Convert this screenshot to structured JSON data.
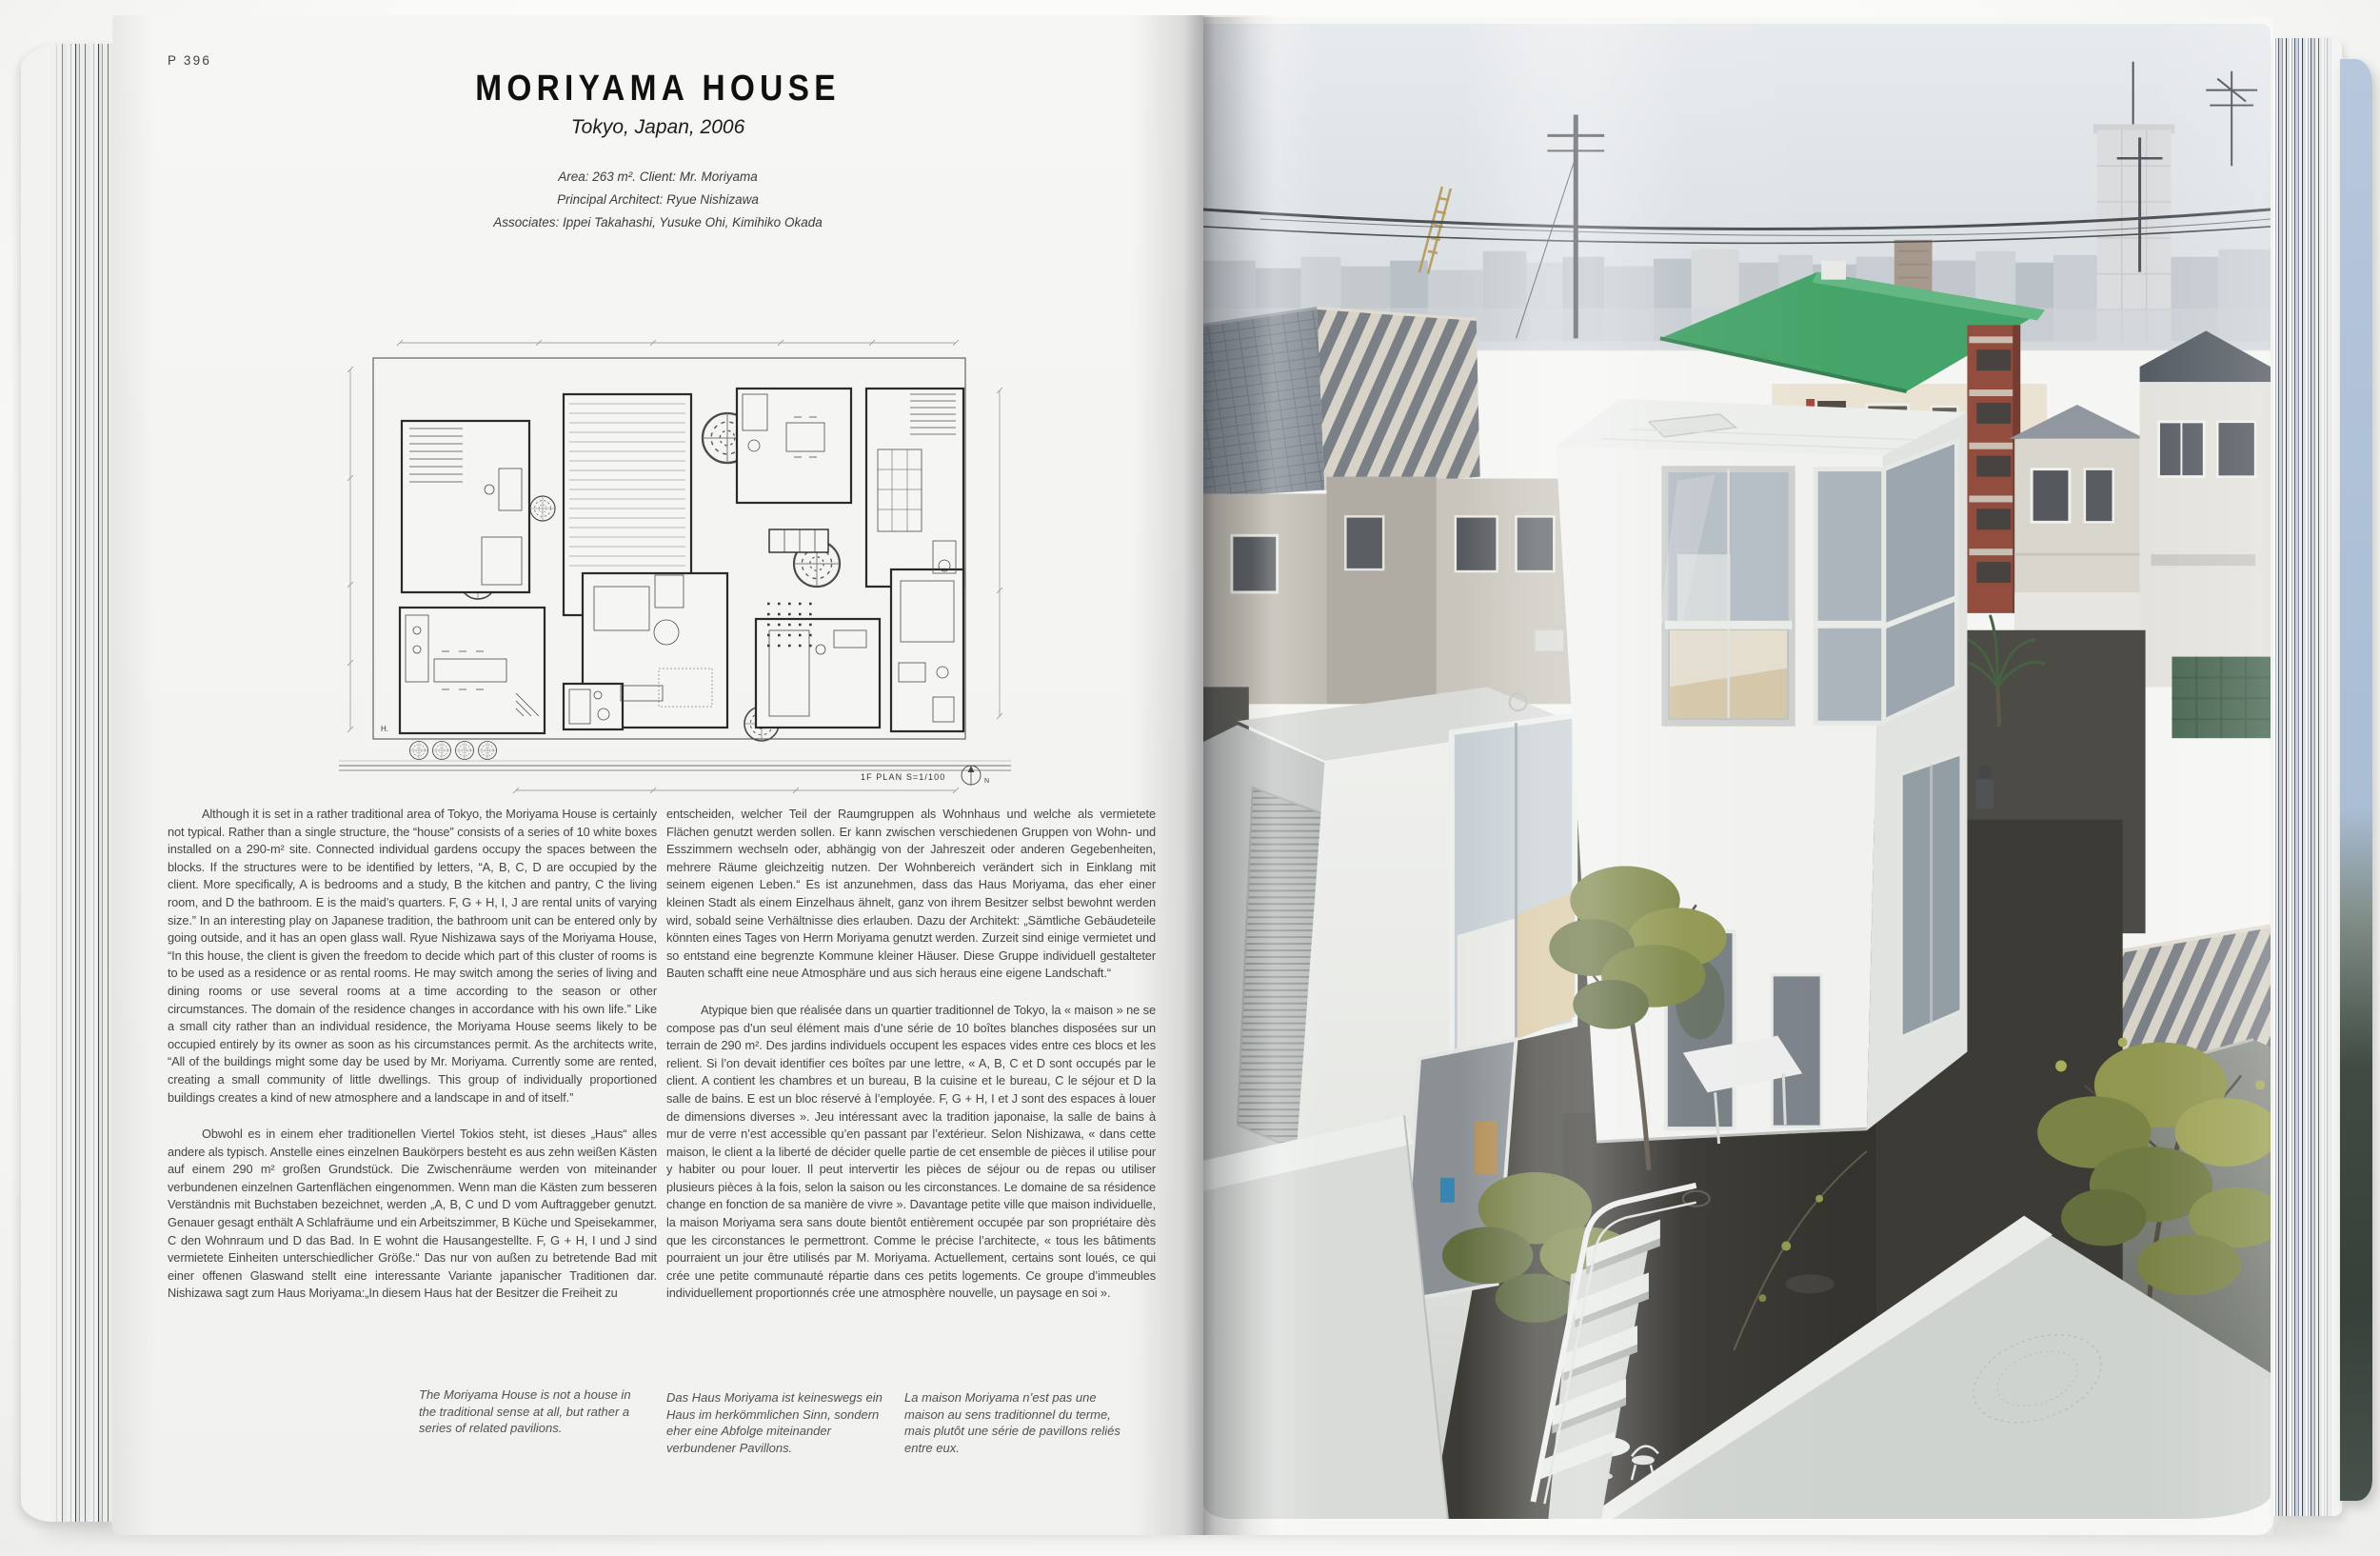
{
  "book": {
    "left_page": {
      "page_number": "P 396",
      "title": "MORIYAMA HOUSE",
      "subtitle": "Tokyo, Japan, 2006",
      "credits": [
        "Area: 263 m². Client: Mr. Moriyama",
        "Principal Architect: Ryue Nishizawa",
        "Associates: Ippei Takahashi, Yusuke Ohi, Kimihiko Okada"
      ],
      "plan_label": "1F PLAN  S=1/100",
      "plan_north": "N",
      "plan_corner_label": "H.",
      "columns": {
        "col1": {
          "en": "Although it is set in a rather traditional area of Tokyo, the Moriyama House is certainly not typical. Rather than a single structure, the “house” consists of a series of 10 white boxes installed on a 290-m² site. Connected individual gardens occupy the spaces between the blocks. If the structures were to be identified by letters, “A, B, C, D are occupied by the client. More specifically, A is bedrooms and a study, B the kitchen and pantry, C the living room, and D the bathroom. E is the maid’s quarters. F, G + H, I, J are rental units of varying size.” In an interesting play on Japanese tradition, the bathroom unit can be entered only by going outside, and it has an open glass wall. Ryue Nishizawa says of the Moriyama House, “In this house, the client is given the freedom to decide which part of this cluster of rooms is to be used as a residence or as rental rooms. He may switch among the series of living and dining rooms or use several rooms at a time according to the season or other circumstances. The domain of the residence changes in accordance with his own life.” Like a small city rather than an individual residence, the Moriyama House seems likely to be occupied entirely by its owner as soon as his circumstances permit. As the architects write, “All of the buildings might some day be used by Mr. Moriyama. Currently some are rented, creating a small community of little dwellings. This group of individually proportioned buildings creates a kind of new atmosphere and a landscape in and of itself.”",
          "de_start": "Obwohl es in einem eher traditionellen Viertel Tokios steht, ist dieses „Haus“ alles andere als typisch. Anstelle eines einzelnen Baukörpers besteht es aus zehn weißen Kästen auf einem 290 m² großen Grundstück. Die Zwischenräume werden von miteinander verbundenen einzelnen Gartenflächen eingenommen. Wenn man die Kästen zum besseren Verständnis mit Buchstaben bezeichnet, werden „A, B, C und D vom Auftraggeber genutzt. Genauer gesagt enthält A Schlafräume und ein Arbeitszimmer, B Küche und Speisekammer, C den Wohnraum und D das Bad. In E wohnt die Hausangestellte. F, G + H, I und J sind vermietete Einheiten unterschiedlicher Größe.“ Das nur von außen zu betretende Bad mit einer offenen Glaswand stellt eine interessante Variante japanischer Traditionen dar. Nishizawa sagt zum Haus Moriyama:„In diesem Haus hat der Besitzer die Freiheit zu"
        },
        "col2": {
          "de_end": "entscheiden, welcher Teil der Raumgruppen als Wohnhaus und welche als vermietete Flächen genutzt werden sollen. Er kann zwischen verschiedenen Gruppen von Wohn- und Esszimmern wechseln oder, abhängig von der Jahreszeit oder anderen Gegebenheiten, mehrere Räume gleichzeitig nutzen. Der Wohnbereich verändert sich in Einklang mit seinem eigenen Leben.“ Es ist anzunehmen, dass das Haus Moriyama, das eher einer kleinen Stadt als einem Einzelhaus ähnelt, ganz von ihrem Besitzer selbst bewohnt werden wird, sobald seine Verhältnisse dies erlauben. Dazu der Architekt: „Sämtliche Gebäudeteile könnten eines Tages von Herrn Moriyama genutzt werden. Zurzeit sind einige vermietet und so entstand eine begrenzte Kommune kleiner Häuser. Diese Gruppe individuell gestalteter Bauten schafft eine neue Atmosphäre und aus sich heraus eine eigene Landschaft.“",
          "fr": "Atypique bien que réalisée dans un quartier traditionnel de Tokyo, la « maison » ne se compose pas d’un seul élément mais d’une série de 10 boîtes blanches disposées sur un terrain de 290 m². Des jardins individuels occupent les espaces vides entre ces blocs et les relient. Si l’on devait identifier ces boîtes par une lettre, « A, B, C et D sont occupés par le client. A contient les chambres et un bureau, B la cuisine et le bureau, C le séjour et D la salle de bains. E est un bloc réservé à l’employée. F, G + H, I et J sont des espaces à louer de dimensions diverses ». Jeu intéressant avec la tradition japonaise, la salle de bains à mur de verre n’est accessible qu’en passant par l’extérieur. Selon Nishizawa, « dans cette maison, le client a la liberté de décider quelle partie de cet ensemble de pièces il utilise pour y habiter ou pour louer. Il peut intervertir les pièces de séjour ou de repas ou utiliser plusieurs pièces à la fois, selon la saison ou les circonstances. Le domaine de sa résidence change en fonction de sa manière de vivre ». Davantage petite ville que maison individuelle, la maison Moriyama sera sans doute bientôt entièrement occupée par son propriétaire dès que les circonstances le permettront. Comme le précise l’architecte, « tous les bâtiments pourraient un jour être utilisés par M. Moriyama. Actuellement, certains sont loués, ce qui crée une petite communauté répartie dans ces petits logements. Ce groupe d’immeubles individuellement proportionnés crée une atmosphère nouvelle, un paysage en soi »."
        }
      },
      "captions": {
        "en": "The Moriyama House is not a house in the traditional sense at all, but rather a series of related pavilions.",
        "de": "Das Haus Moriyama ist keineswegs ein Haus im herkömmlichen Sinn, sondern eher eine Abfolge miteinander verbundener Pavillons.",
        "fr": "La maison Moriyama n’est pas une maison au sens traditionnel du terme, mais plutôt une série de pavillons reliés entre eux."
      }
    },
    "right_page": {
      "photo_alt": "Aerial view of the Moriyama House: a cluster of white box-like pavilions with large windows set among tiled roofs, gardens, trees and power lines of a dense Tokyo neighborhood.",
      "palette": {
        "sky": "#e0e4e7",
        "white_box": "#f2f3f1",
        "green_roof": "#3da162",
        "brick": "#8e4536",
        "tile_roof": "#828992",
        "foliage": "#8d9348",
        "courtyard": "#33322c"
      }
    }
  }
}
